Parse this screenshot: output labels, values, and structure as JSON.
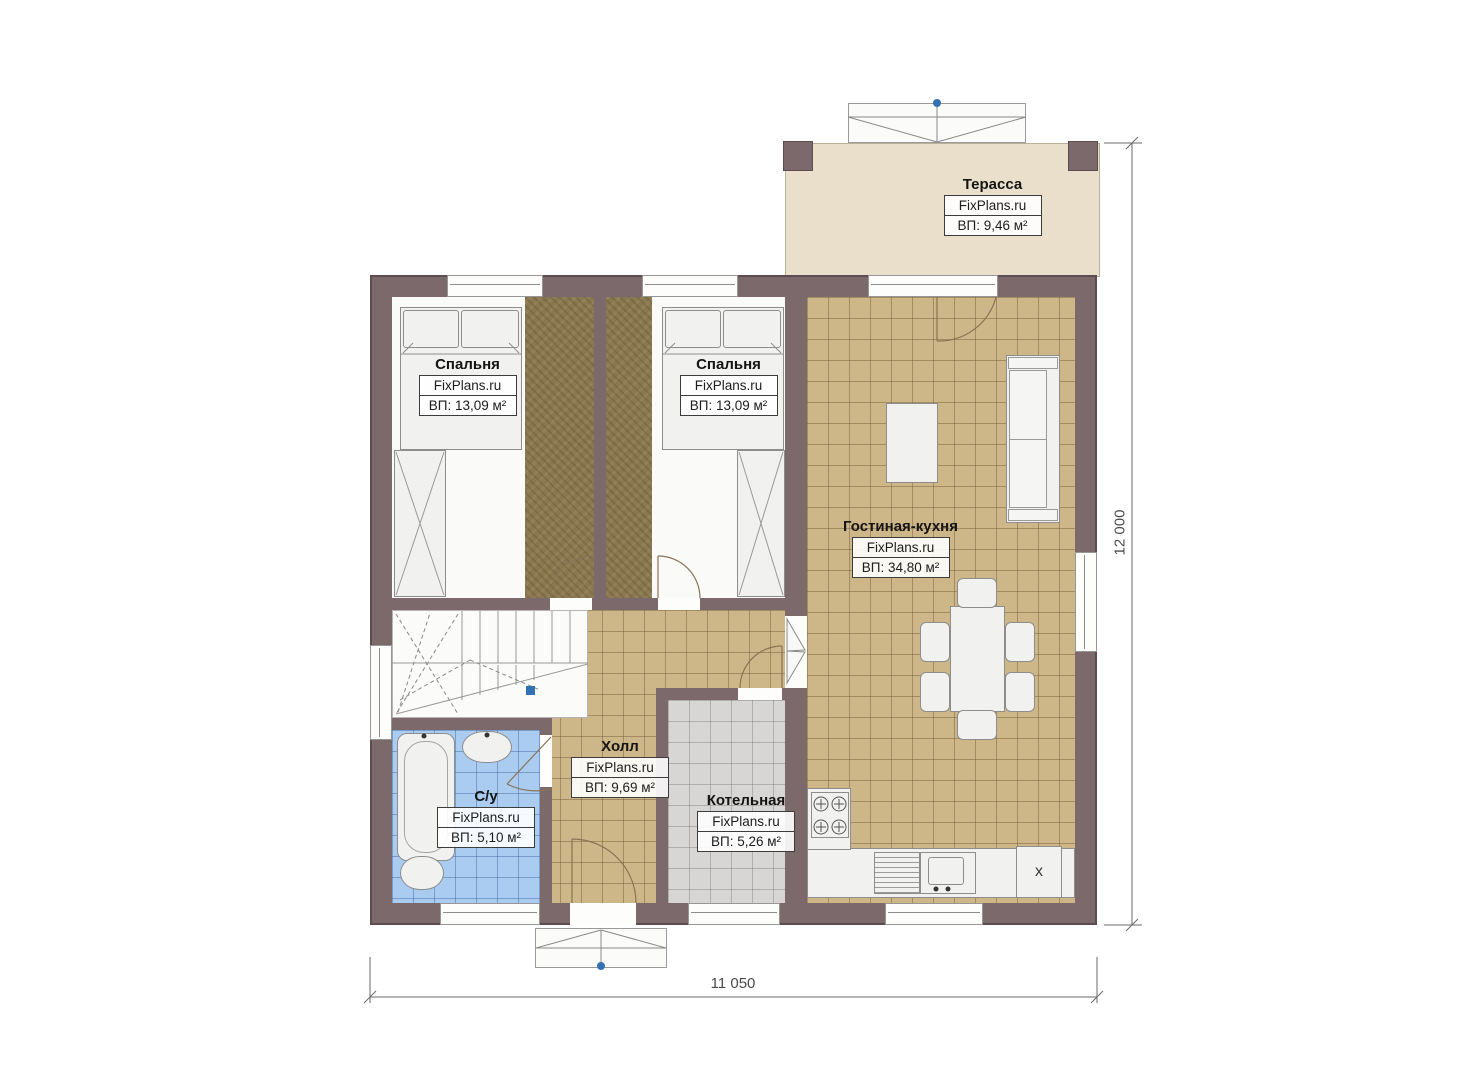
{
  "plan": {
    "brand": "FixPlans.ru",
    "rooms": {
      "terrace": {
        "name": "Терасса",
        "brand": "FixPlans.ru",
        "area": "ВП: 9,46 м²"
      },
      "bedroom1": {
        "name": "Спальня",
        "brand": "FixPlans.ru",
        "area": "ВП: 13,09 м²"
      },
      "bedroom2": {
        "name": "Спальня",
        "brand": "FixPlans.ru",
        "area": "ВП: 13,09 м²"
      },
      "living": {
        "name": "Гостиная-кухня",
        "brand": "FixPlans.ru",
        "area": "ВП: 34,80 м²"
      },
      "hall": {
        "name": "Холл",
        "brand": "FixPlans.ru",
        "area": "ВП: 9,69 м²"
      },
      "bathroom": {
        "name": "С/у",
        "brand": "FixPlans.ru",
        "area": "ВП: 5,10 м²"
      },
      "boiler": {
        "name": "Котельная",
        "brand": "FixPlans.ru",
        "area": "ВП: 5,26 м²"
      }
    },
    "dimensions": {
      "horizontal": "11 050",
      "vertical": "12 000"
    },
    "symbols": {
      "fridge_mark": "x"
    },
    "colors": {
      "wall": "#7c696c",
      "tile_tan": "#cdb687",
      "tile_blue": "#a9ccf0",
      "tile_gray": "#d7d6d4",
      "carpet": "#8a7850",
      "terrace": "#e9dfcb",
      "marker_blue": "#3470b4"
    }
  }
}
